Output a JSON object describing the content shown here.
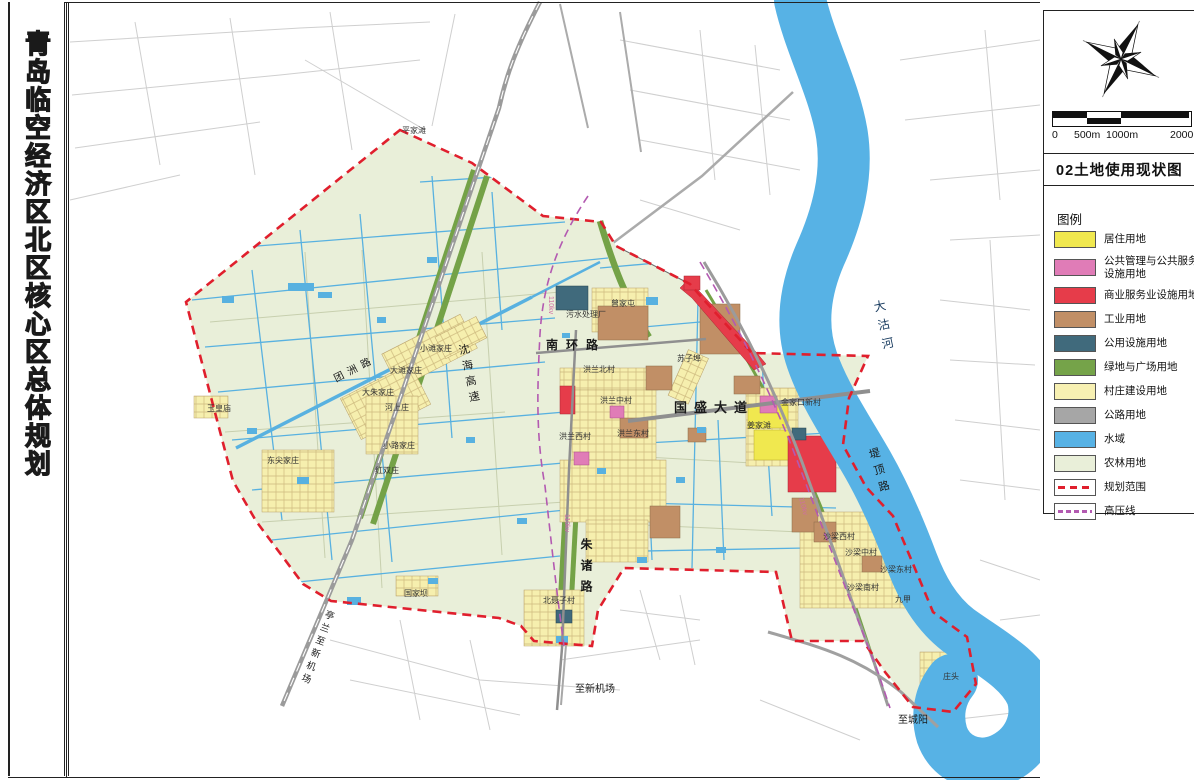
{
  "sheet": {
    "side_title": "青岛临空经济区北区核心区总体规划"
  },
  "panel": {
    "map_title": "02土地使用现状图",
    "legend_title": "图例",
    "scale_labels": [
      "0",
      "500m",
      "1000m",
      "2000m"
    ],
    "compass": "north-compass-rose",
    "legend_items": [
      {
        "label": "居住用地",
        "type": "fill",
        "color": "#f0e84f"
      },
      {
        "label": "公共管理与公共服务设施用地",
        "type": "fill",
        "color": "#e07cb7"
      },
      {
        "label": "商业服务业设施用地",
        "type": "fill",
        "color": "#e63c4a"
      },
      {
        "label": "工业用地",
        "type": "fill",
        "color": "#c18f66"
      },
      {
        "label": "公用设施用地",
        "type": "fill",
        "color": "#406a7c"
      },
      {
        "label": "绿地与广场用地",
        "type": "fill",
        "color": "#75a349"
      },
      {
        "label": "村庄建设用地",
        "type": "fill",
        "color": "#f7f0b2"
      },
      {
        "label": "公路用地",
        "type": "fill",
        "color": "#a6a6a6"
      },
      {
        "label": "水域",
        "type": "fill",
        "color": "#57b2e5"
      },
      {
        "label": "农林用地",
        "type": "fill",
        "color": "#e9efd9"
      },
      {
        "label": "规划范围",
        "type": "dashed",
        "color": "#e01f2d"
      },
      {
        "label": "高压线",
        "type": "dashdot",
        "color": "#b35ab1"
      }
    ]
  },
  "map": {
    "labels": [
      {
        "text": "南环路",
        "x": 546,
        "y": 349,
        "size": 12,
        "ls": 8,
        "bold": true,
        "kind": "road"
      },
      {
        "text": "国盛大道",
        "x": 674,
        "y": 412,
        "size": 13,
        "ls": 7,
        "bold": true,
        "kind": "road"
      },
      {
        "text": "沈海高速",
        "x": 462,
        "y": 344,
        "size": 11,
        "ls": 5,
        "vertical": true,
        "rot": -12,
        "kind": "road"
      },
      {
        "text": "朱诸路",
        "x": 586,
        "y": 538,
        "size": 12,
        "ls": 9,
        "vertical": true,
        "bold": true,
        "kind": "road"
      },
      {
        "text": "堤顶路",
        "x": 872,
        "y": 448,
        "size": 11,
        "ls": 6,
        "vertical": true,
        "rot": -16,
        "kind": "road"
      },
      {
        "text": "团洲路",
        "x": 336,
        "y": 382,
        "size": 10,
        "ls": 5,
        "rot": -27,
        "kind": "road"
      },
      {
        "text": "亭兰至新机场",
        "x": 330,
        "y": 610,
        "size": 9.5,
        "ls": 4,
        "vertical": true,
        "rot": 20,
        "kind": "road"
      },
      {
        "text": "至新机场",
        "x": 575,
        "y": 692,
        "size": 10,
        "kind": "road"
      },
      {
        "text": "至城阳",
        "x": 898,
        "y": 723,
        "size": 10,
        "kind": "road"
      },
      {
        "text": "大沽河",
        "x": 878,
        "y": 300,
        "size": 12,
        "ls": 7,
        "vertical": true,
        "rot": -12,
        "color": "#173a5e",
        "kind": "water"
      },
      {
        "text": "平家滩",
        "x": 402,
        "y": 133,
        "size": 8,
        "kind": "place"
      },
      {
        "text": "曾家屯",
        "x": 611,
        "y": 306,
        "size": 8,
        "kind": "place"
      },
      {
        "text": "污水处理厂",
        "x": 566,
        "y": 317,
        "size": 8,
        "kind": "place"
      },
      {
        "text": "洪兰北村",
        "x": 583,
        "y": 372,
        "size": 8,
        "kind": "place"
      },
      {
        "text": "洪兰中村",
        "x": 600,
        "y": 403,
        "size": 8,
        "kind": "place"
      },
      {
        "text": "洪兰西村",
        "x": 559,
        "y": 439,
        "size": 8,
        "kind": "place"
      },
      {
        "text": "洪兰东村",
        "x": 617,
        "y": 436,
        "size": 8,
        "kind": "place"
      },
      {
        "text": "苏子埠",
        "x": 677,
        "y": 361,
        "size": 8,
        "kind": "place"
      },
      {
        "text": "姜家滩",
        "x": 747,
        "y": 428,
        "size": 8,
        "kind": "place"
      },
      {
        "text": "金家口新村",
        "x": 781,
        "y": 405,
        "size": 8,
        "kind": "place"
      },
      {
        "text": "小滩家庄",
        "x": 420,
        "y": 351,
        "size": 8,
        "kind": "place"
      },
      {
        "text": "大滩家庄",
        "x": 390,
        "y": 373,
        "size": 8,
        "kind": "place"
      },
      {
        "text": "大朱家庄",
        "x": 362,
        "y": 395,
        "size": 8,
        "kind": "place"
      },
      {
        "text": "河上庄",
        "x": 385,
        "y": 410,
        "size": 8,
        "kind": "place"
      },
      {
        "text": "玉皇庙",
        "x": 207,
        "y": 411,
        "size": 8,
        "kind": "place"
      },
      {
        "text": "小路家庄",
        "x": 383,
        "y": 448,
        "size": 8,
        "kind": "place"
      },
      {
        "text": "东尖家庄",
        "x": 267,
        "y": 463,
        "size": 8,
        "kind": "place"
      },
      {
        "text": "红双庄",
        "x": 375,
        "y": 473,
        "size": 8,
        "kind": "place"
      },
      {
        "text": "国家坝",
        "x": 404,
        "y": 596,
        "size": 8,
        "kind": "place"
      },
      {
        "text": "北聂子村",
        "x": 543,
        "y": 603,
        "size": 8,
        "kind": "place"
      },
      {
        "text": "沙梁西村",
        "x": 823,
        "y": 539,
        "size": 8,
        "kind": "place"
      },
      {
        "text": "沙梁中村",
        "x": 845,
        "y": 555,
        "size": 8,
        "kind": "place"
      },
      {
        "text": "沙梁东村",
        "x": 880,
        "y": 572,
        "size": 8,
        "kind": "place"
      },
      {
        "text": "沙梁南村",
        "x": 847,
        "y": 590,
        "size": 8,
        "kind": "place"
      },
      {
        "text": "九甲",
        "x": 895,
        "y": 602,
        "size": 8,
        "kind": "place"
      },
      {
        "text": "庄头",
        "x": 943,
        "y": 679,
        "size": 8,
        "kind": "place"
      },
      {
        "text": "110kv",
        "x": 549,
        "y": 296,
        "size": 7,
        "rot": 90,
        "color": "#cf6da4",
        "kind": "hv"
      },
      {
        "text": "110kv",
        "x": 565,
        "y": 514,
        "size": 7,
        "rot": 90,
        "color": "#cf6da4",
        "kind": "hv"
      },
      {
        "text": "110kv",
        "x": 799,
        "y": 498,
        "size": 7,
        "rot": 75,
        "color": "#cf6da4",
        "kind": "hv"
      }
    ]
  }
}
